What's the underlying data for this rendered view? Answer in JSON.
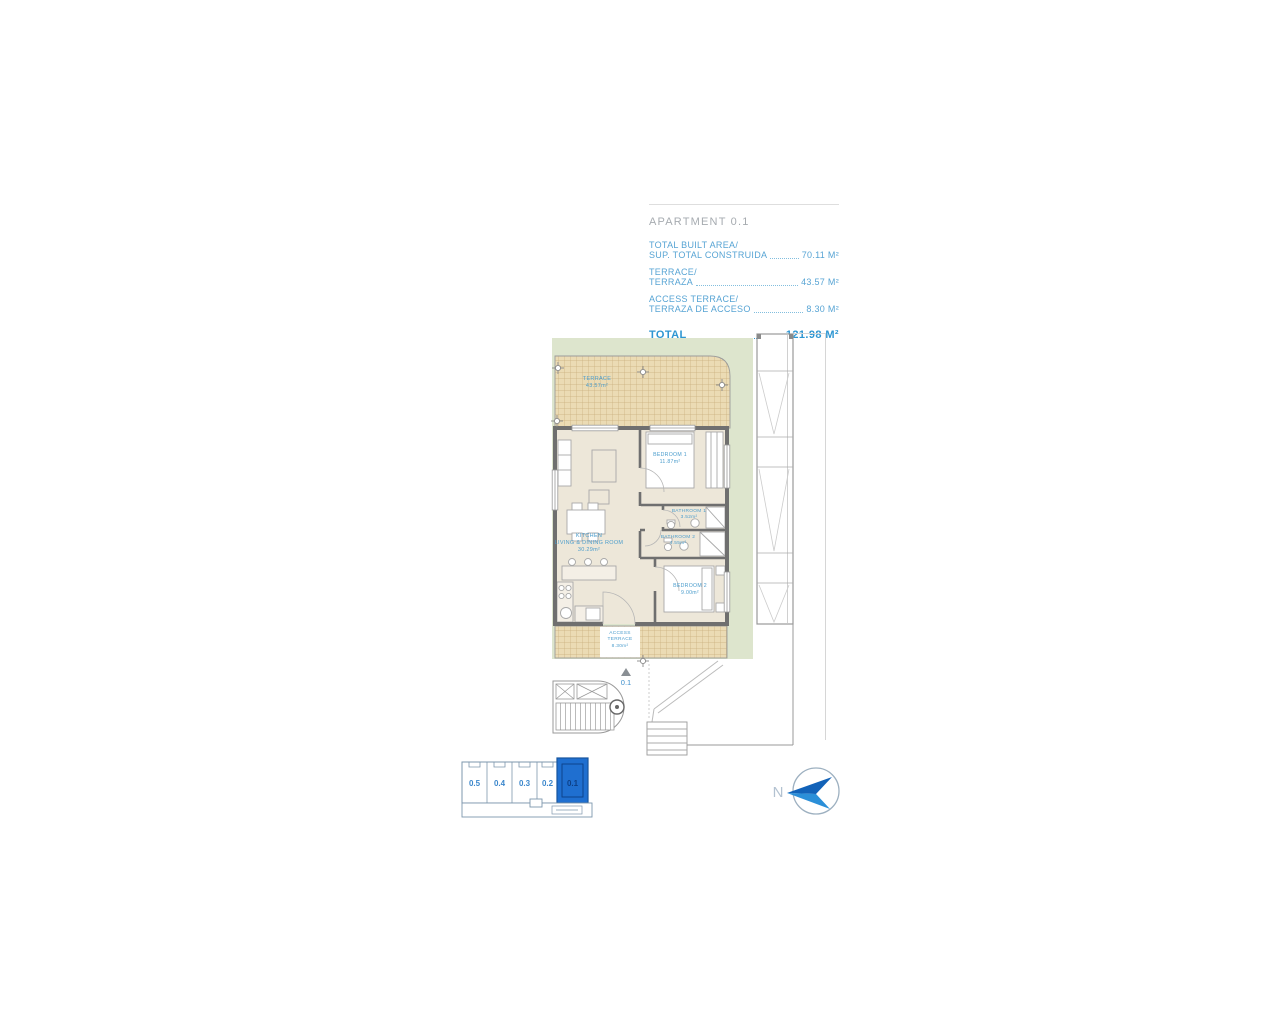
{
  "header": {
    "title": "APARTMENT 0.1",
    "rows": [
      {
        "line1": "TOTAL BUILT AREA/",
        "line2": "SUP. TOTAL CONSTRUIDA",
        "value": "70.11 M²"
      },
      {
        "line1": "TERRACE/",
        "line2": "TERRAZA",
        "value": "43.57 M²"
      },
      {
        "line1": "ACCESS TERRACE/",
        "line2": "TERRAZA DE ACCESO",
        "value": "8.30 M²"
      }
    ],
    "total_label": "TOTAL",
    "total_value": "121.98 M²"
  },
  "plan": {
    "terrace": {
      "name": "TERRACE",
      "area": "43.57m²"
    },
    "living": {
      "line1": "KITCHEN",
      "line2": "LIVING & DINING ROOM",
      "area": "30.29m²"
    },
    "bedroom1": {
      "name": "BEDROOM 1",
      "area": "11.87m²"
    },
    "bathroom1": {
      "name": "BATHROOM 1",
      "area": "3.52m²"
    },
    "bathroom2": {
      "name": "BATHROOM 2",
      "area": "4.55m²"
    },
    "bedroom2": {
      "name": "BEDROOM 2",
      "area": "9.00m²"
    },
    "access_terrace": {
      "line1": "ACCESS",
      "line2": "TERRACE",
      "area": "8.30m²"
    },
    "unit_marker": "0.1"
  },
  "keyplan": {
    "units": [
      "0.5",
      "0.4",
      "0.3",
      "0.2",
      "0.1"
    ],
    "highlighted_unit": "0.1"
  },
  "compass": {
    "north_label": "N"
  },
  "colors": {
    "accent_blue": "#57a4d4",
    "total_blue": "#2e96d2",
    "keyplan_blue": "#1f6fd0",
    "plot_green": "#dde5cd",
    "terrace_tan": "#ebdbb4"
  }
}
